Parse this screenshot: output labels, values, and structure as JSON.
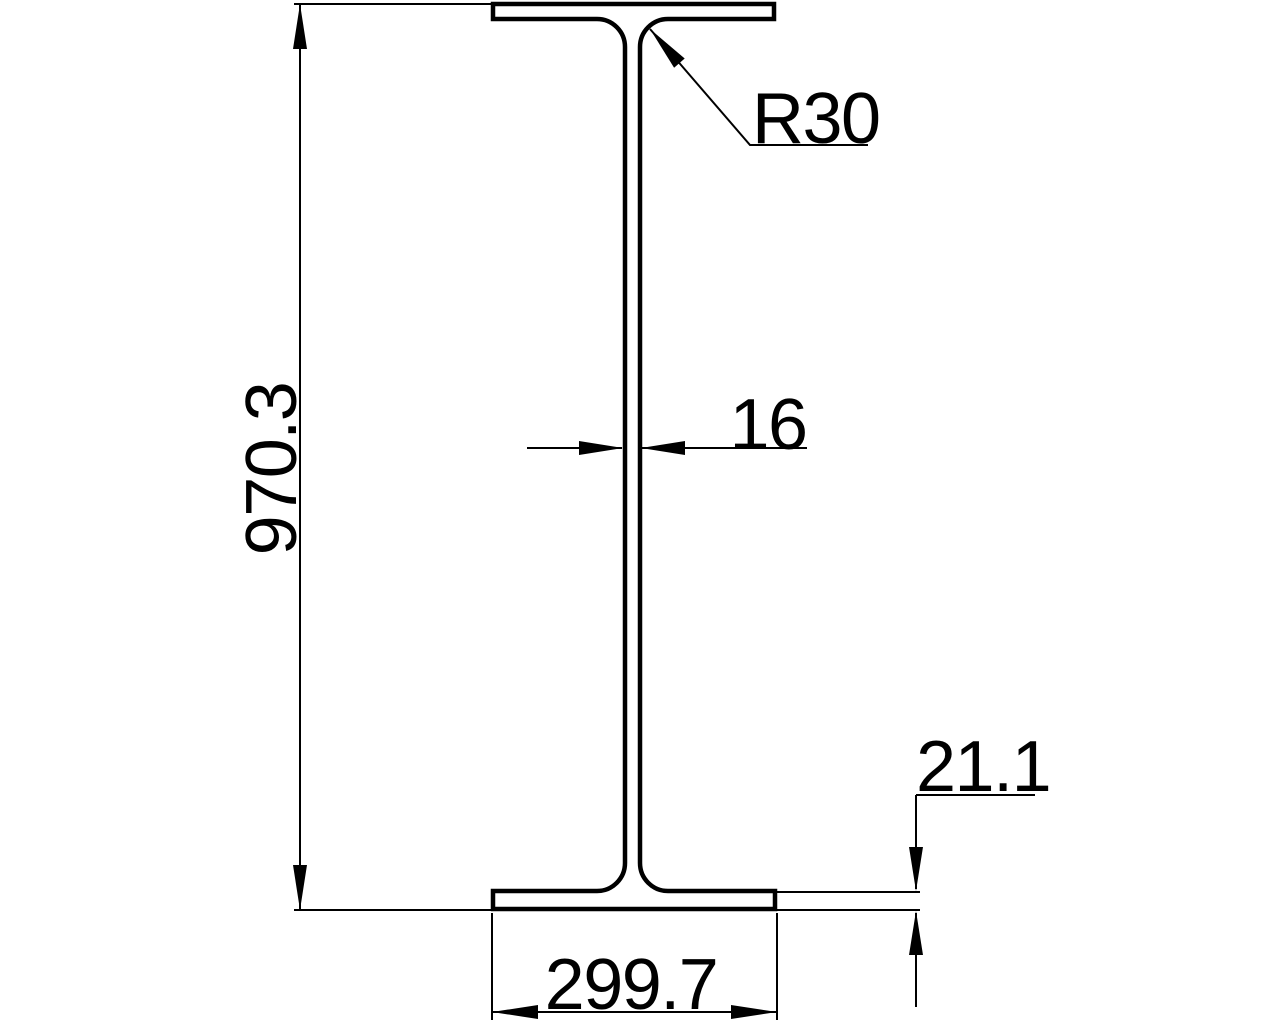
{
  "drawing": {
    "background_color": "#ffffff",
    "line_color": "#000000",
    "dimensions": {
      "overall_height": {
        "label": "970.3"
      },
      "web_thickness": {
        "label": "16"
      },
      "fillet_radius": {
        "label": "R30"
      },
      "flange_thickness": {
        "label": "21.1"
      },
      "flange_width": {
        "label": "299.7"
      }
    }
  }
}
